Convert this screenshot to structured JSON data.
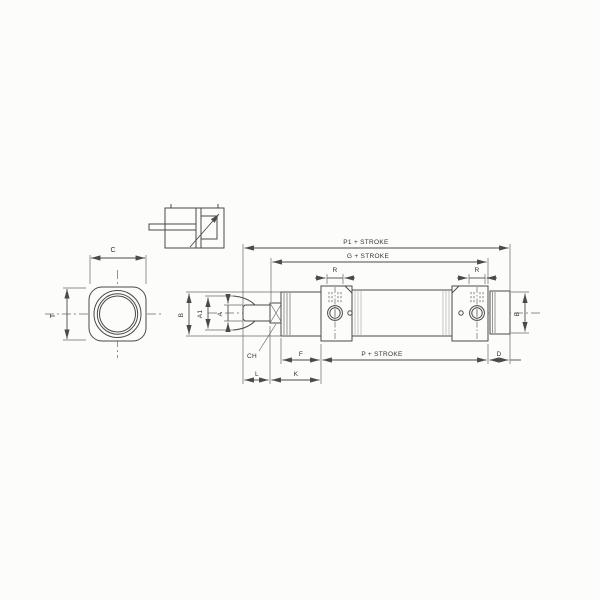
{
  "drawing": {
    "type": "technical-drawing",
    "views": {
      "end_view": {
        "dim_c": "C",
        "dim_t": "T"
      },
      "symbol": {},
      "side_view": {
        "dim_p1_stroke": "P1 + STROKE",
        "dim_g_stroke": "G + STROKE",
        "dim_p_stroke": "P + STROKE",
        "dim_r_left": "R",
        "dim_r_right": "R",
        "dim_b_left": "B",
        "dim_a1": "A1",
        "dim_a": "A",
        "dim_ch": "CH",
        "dim_l": "L",
        "dim_k": "K",
        "dim_f": "F",
        "dim_d": "D",
        "dim_b_right": "B"
      }
    },
    "colors": {
      "line": "#4a4a4a",
      "paper": "#fcfcfb"
    }
  }
}
